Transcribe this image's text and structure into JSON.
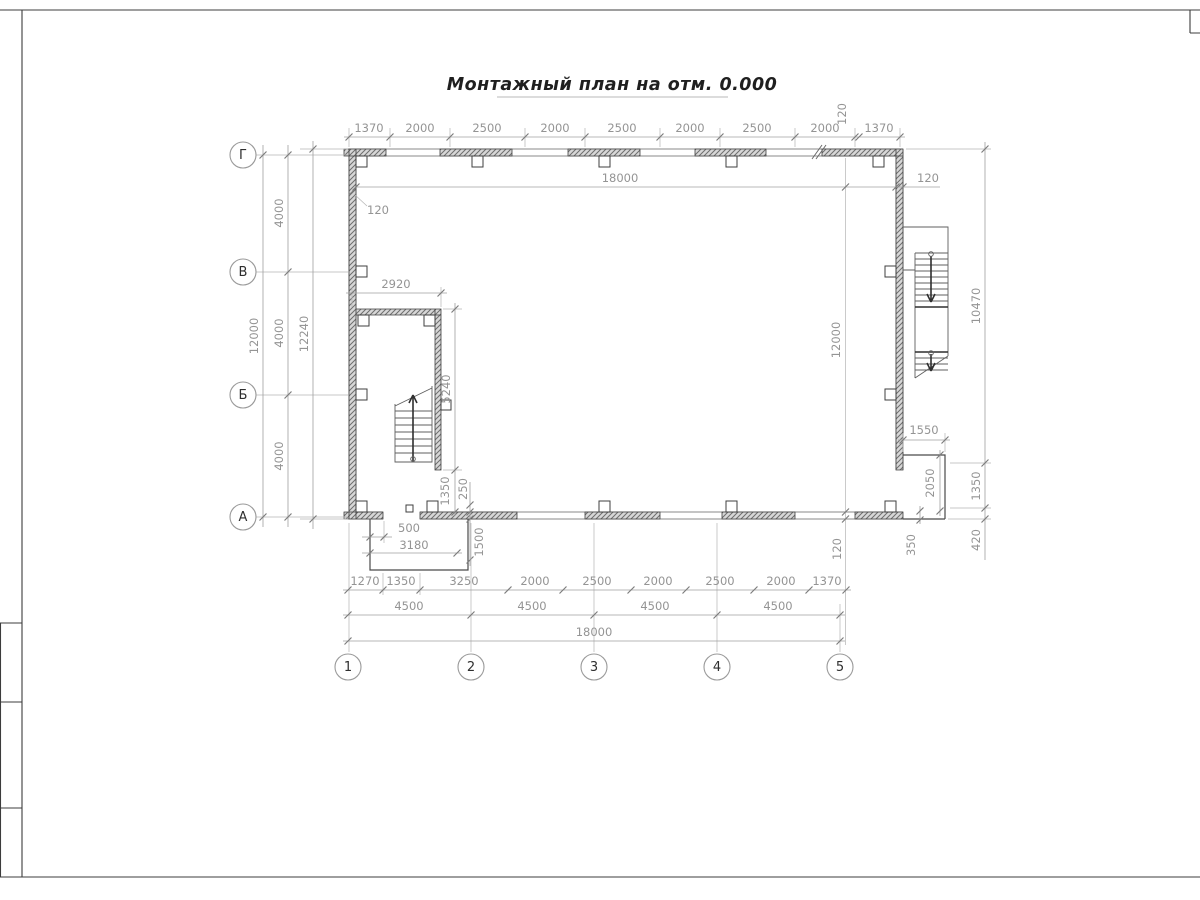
{
  "sheet": {
    "title": "Монтажный план на отм. 0.000"
  },
  "axes": {
    "rows": [
      "Г",
      "В",
      "Б",
      "А"
    ],
    "cols": [
      "1",
      "2",
      "3",
      "4",
      "5"
    ]
  },
  "dims": {
    "top": {
      "chain": [
        "1370",
        "2000",
        "2500",
        "2000",
        "2500",
        "2000",
        "2500",
        "2000",
        "1370"
      ],
      "offset": "120",
      "total": "18000",
      "wall": "120",
      "corner": "120"
    },
    "left": {
      "total": "12000",
      "steps": [
        "4000",
        "4000",
        "4000"
      ],
      "overall": "12240"
    },
    "room": {
      "width": "2920",
      "height": "5240",
      "gap": "1350",
      "offset": "250"
    },
    "porch_left": {
      "offset": "500",
      "width": "3180",
      "depth": "1500"
    },
    "bottom": {
      "chain": [
        "1270",
        "1350",
        "3250",
        "2000",
        "2500",
        "2000",
        "2500",
        "2000",
        "1370"
      ],
      "steps": [
        "4500",
        "4500",
        "4500",
        "4500"
      ],
      "total": "18000"
    },
    "right": {
      "inner": "12000",
      "wall": "120",
      "upper": "10470",
      "mid": "1350",
      "lower": "420",
      "porch_width": "1550",
      "porch_depth": "2050",
      "porch_offset": "350"
    }
  }
}
